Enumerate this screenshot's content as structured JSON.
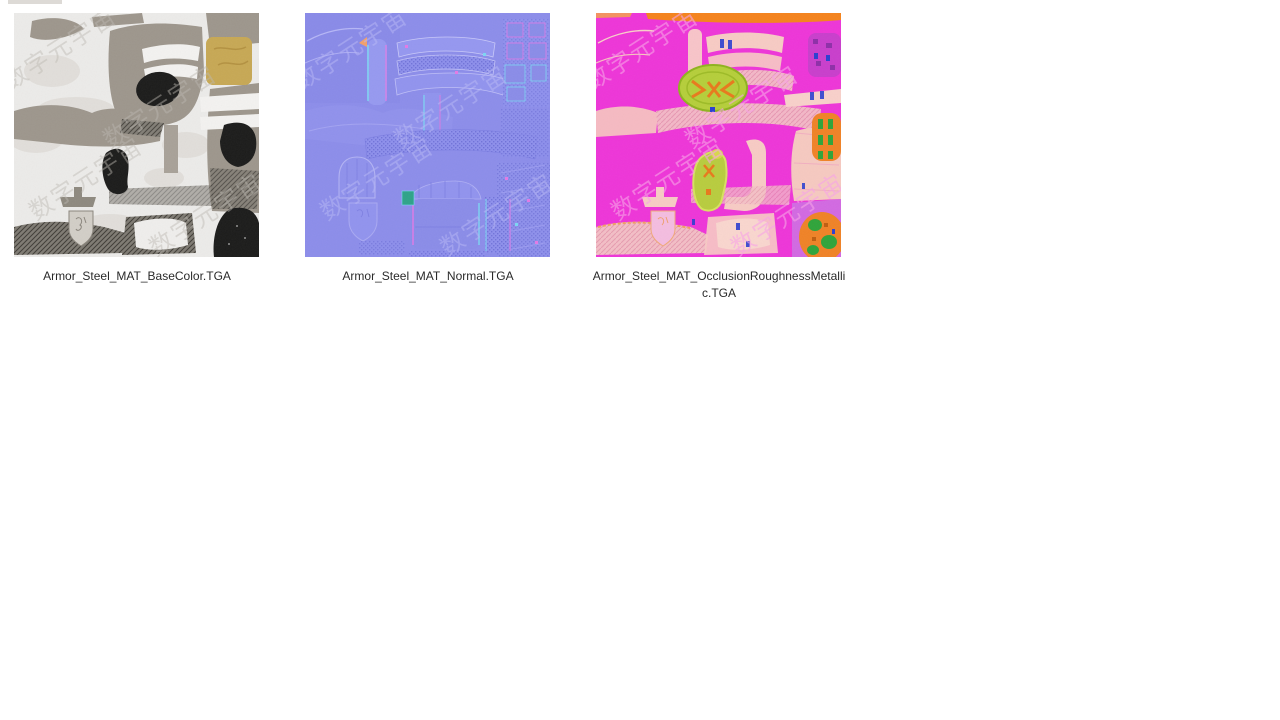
{
  "window": {
    "background": "#ffffff"
  },
  "watermark": {
    "text": "数字元宇宙"
  },
  "files": [
    {
      "name": "Armor_Steel_MAT_BaseColor.TGA",
      "kind": "basecolor-texture"
    },
    {
      "name": "Armor_Steel_MAT_Normal.TGA",
      "kind": "normal-map-texture"
    },
    {
      "name": "Armor_Steel_MAT_OcclusionRoughnessMetallic.TGA",
      "kind": "orm-texture"
    }
  ],
  "palette": {
    "basecolor_bg": "#ECEBE9",
    "basecolor_taupe": "#9D968C",
    "basecolor_gold": "#C7A854",
    "basecolor_black": "#1B1B1A",
    "normal_base": "#8C8DEA",
    "normal_cyan_fringe": "#7CD6F2",
    "normal_pink_fringe": "#E27AE6",
    "orm_magenta": "#EE35D8",
    "orm_pink": "#F6C9C0",
    "orm_orange": "#F5831C",
    "orm_green_yellow": "#B5CE3A",
    "orm_green": "#2FA43A",
    "orm_purple_patch": "#C93ECC",
    "label_color": "#2A2A2A"
  }
}
